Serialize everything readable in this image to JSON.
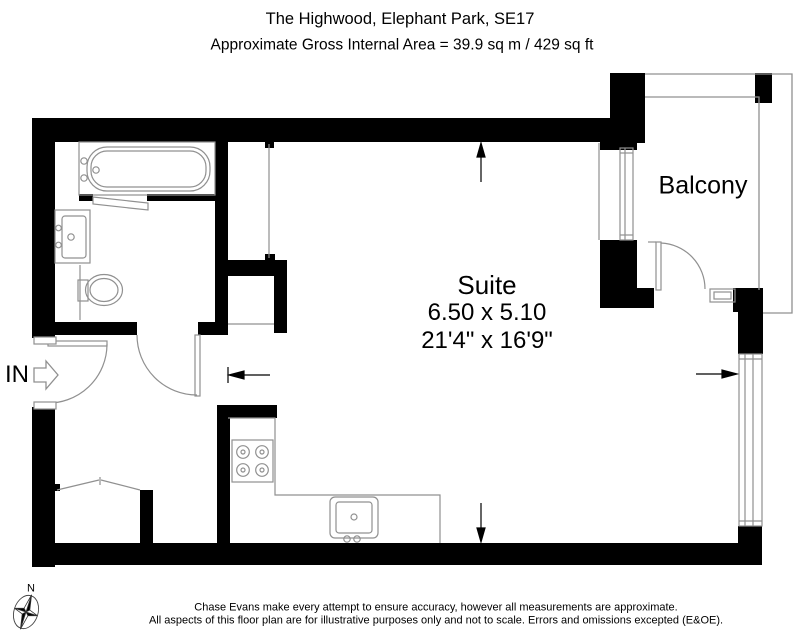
{
  "header": {
    "title": "The Highwood, Elephant Park, SE17",
    "area_line": "Approximate Gross Internal Area = 39.9 sq m / 429 sq ft"
  },
  "rooms": {
    "suite": {
      "name": "Suite",
      "dim_metric": "6.50 x 5.10",
      "dim_imperial": "21'4\" x 16'9\""
    },
    "balcony": {
      "name": "Balcony"
    }
  },
  "entrance": {
    "label": "IN"
  },
  "compass": {
    "label": "N"
  },
  "footer": {
    "line1": "Chase Evans make every attempt to ensure accuracy, however all measurements are approximate.",
    "line2": "All aspects of this floor plan are for illustrative purposes only and not to scale. Errors and omissions excepted (E&OE)."
  },
  "colors": {
    "wall": "#000000",
    "fixture_line": "#909090",
    "dimension": "#000000"
  }
}
